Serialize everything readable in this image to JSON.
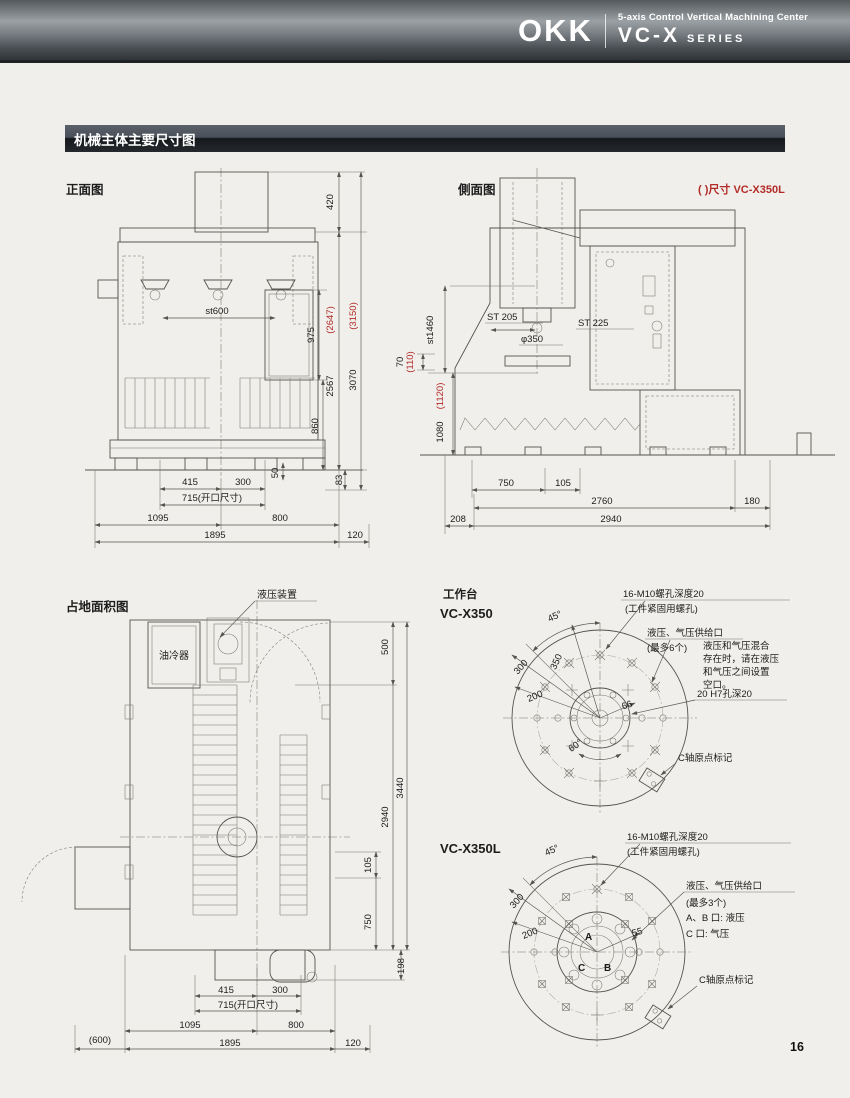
{
  "header": {
    "logo": "OKK",
    "subtitle": "5-axis Control Vertical Machining Center",
    "series_name": "VC-X",
    "series_suffix": "SERIES"
  },
  "section": {
    "title": "机械主体主要尺寸图"
  },
  "notes": {
    "paren_note": "( )尺寸 VC-X350L"
  },
  "page": {
    "number": "16"
  },
  "colors": {
    "red": "#b32b27",
    "line": "#54544f",
    "bg": "#f0efeb"
  },
  "front": {
    "label": "正面图",
    "dims": {
      "h420": "420",
      "h975": "975",
      "h2567": "2567",
      "h2647": "(2647)",
      "h3070": "3070",
      "h3150": "(3150)",
      "h860": "860",
      "h50": "50",
      "h83": "83",
      "st600": "st600",
      "b415": "415",
      "b300": "300",
      "b715": "715(开口尺寸)",
      "b1095": "1095",
      "b800": "800",
      "b1895": "1895",
      "b120": "120"
    }
  },
  "side": {
    "label": "側面图",
    "dims": {
      "st1460": "st1460",
      "h70": "70",
      "h110": "(110)",
      "h1080": "1080",
      "h1120": "(1120)",
      "st205": "ST 205",
      "st225": "ST 225",
      "dia350": "φ350",
      "b750": "750",
      "b105": "105",
      "b2760": "2760",
      "b180": "180",
      "b208": "208",
      "b2940": "2940"
    }
  },
  "floor": {
    "label": "占地面积图",
    "hydraulic": "液压装置",
    "oil_cooler": "油冷器",
    "dims": {
      "r500": "500",
      "r3440": "3440",
      "r2940": "2940",
      "r105": "105",
      "r750": "750",
      "r198": "198",
      "b415": "415",
      "b300": "300",
      "b715": "715(开口尺寸)",
      "b1095": "1095",
      "b800": "800",
      "b600": "(600)",
      "b1895": "1895",
      "b120": "120"
    }
  },
  "worktable": {
    "label": "工作台",
    "x350": {
      "model": "VC-X350",
      "bolt_note1": "16-M10螺孔深度20",
      "bolt_note2": "(工件紧固用螺孔)",
      "supply1": "液压、气压供给口",
      "supply2": "(最多6个)",
      "mix_note_lines": [
        "液压和气压混合",
        "存在时，请在液压",
        "和气压之间设置",
        "空口。"
      ],
      "hole20": "20 H7孔深20",
      "c_origin": "C轴原点标记",
      "a45": "45°",
      "a60": "60°",
      "d300": "300",
      "d350": "350",
      "d200": "200",
      "d66": "66"
    },
    "x350l": {
      "model": "VC-X350L",
      "bolt_note1": "16-M10螺孔深度20",
      "bolt_note2": "(工件紧固用螺孔)",
      "supply1": "液压、气压供给口",
      "supply2": "(最多3个)",
      "supply3": "A、B 口: 液压",
      "supply4": "C 口: 气压",
      "c_origin": "C轴原点标记",
      "a45": "45°",
      "d300": "300",
      "d200": "200",
      "d55": "55",
      "portA": "A",
      "portB": "B",
      "portC": "C"
    }
  }
}
